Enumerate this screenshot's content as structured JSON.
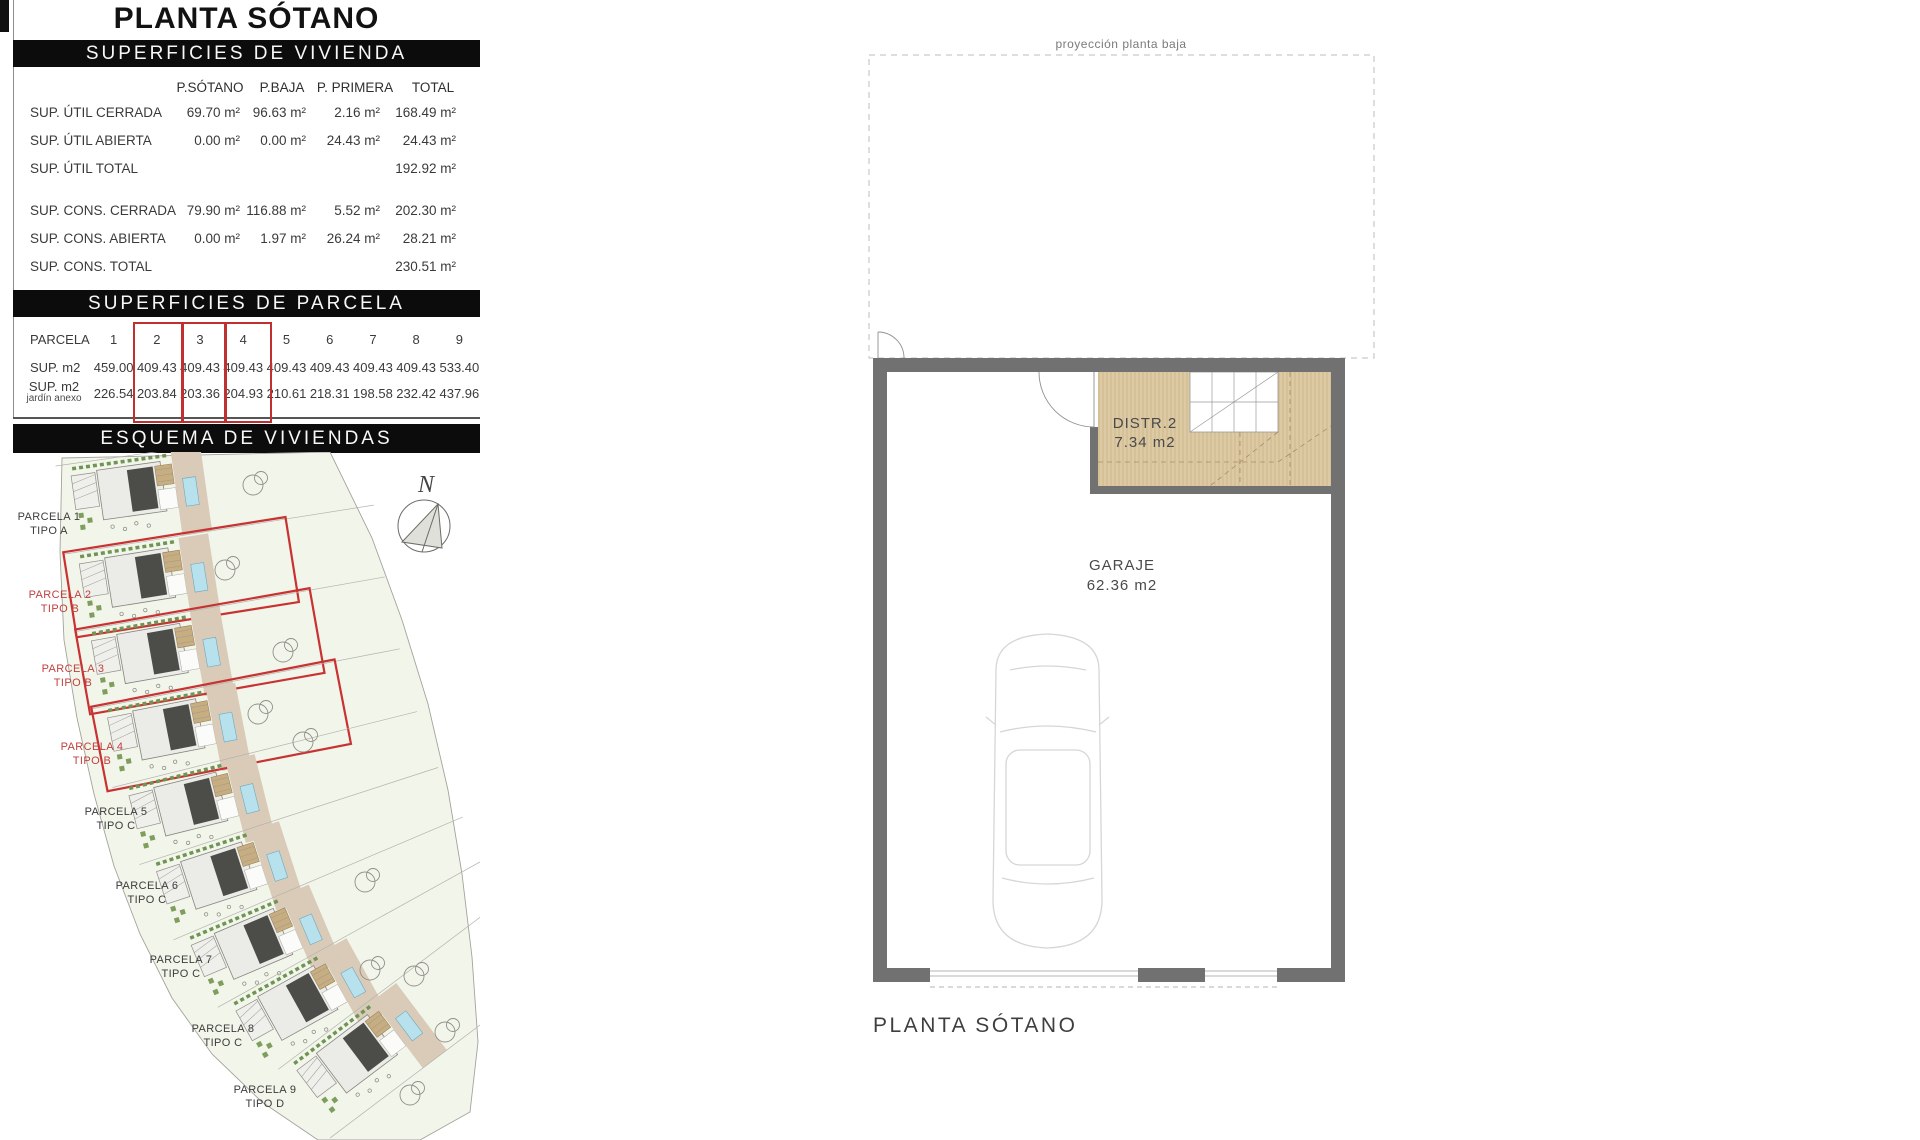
{
  "page": {
    "title": "PLANTA SÓTANO"
  },
  "viviendas": {
    "header": "SUPERFICIES DE VIVIENDA",
    "columns": [
      "P.SÓTANO",
      "P.BAJA",
      "P. PRIMERA",
      "TOTAL"
    ],
    "rows": [
      {
        "label": "SUP. ÚTIL CERRADA",
        "values": [
          "69.70 m²",
          "96.63 m²",
          "2.16 m²",
          "168.49 m²"
        ]
      },
      {
        "label": "SUP. ÚTIL ABIERTA",
        "values": [
          "0.00 m²",
          "0.00 m²",
          "24.43 m²",
          "24.43 m²"
        ]
      },
      {
        "label": "SUP. ÚTIL TOTAL",
        "values": [
          "",
          "",
          "",
          "192.92 m²"
        ]
      },
      {
        "label": "SUP. CONS.  CERRADA",
        "values": [
          "79.90 m²",
          "116.88 m²",
          "5.52 m²",
          "202.30 m²"
        ]
      },
      {
        "label": "SUP. CONS.  ABIERTA",
        "values": [
          "0.00 m²",
          "1.97 m²",
          "26.24 m²",
          "28.21 m²"
        ]
      },
      {
        "label": "SUP. CONS.  TOTAL",
        "values": [
          "",
          "",
          "",
          "230.51 m²"
        ]
      }
    ]
  },
  "parcelas": {
    "header": "SUPERFICIES DE PARCELA",
    "row1_label": "PARCELA",
    "row2_label": "SUP. m2",
    "row3_label_line1": "SUP. m2",
    "row3_label_line2": "jardín anexo",
    "numbers": [
      "1",
      "2",
      "3",
      "4",
      "5",
      "6",
      "7",
      "8",
      "9"
    ],
    "sup_m2": [
      "459.00",
      "409.43",
      "409.43",
      "409.43",
      "409.43",
      "409.43",
      "409.43",
      "409.43",
      "533.40"
    ],
    "jardin": [
      "226.54",
      "203.84",
      "203.36",
      "204.93",
      "210.61",
      "218.31",
      "198.58",
      "232.42",
      "437.96"
    ],
    "highlighted_columns": [
      "2",
      "3",
      "4"
    ]
  },
  "esquema": {
    "header": "ESQUEMA DE VIVIENDAS",
    "north_label": "N",
    "parcels": [
      {
        "name": "PARCELA 1",
        "tipo": "TIPO A"
      },
      {
        "name": "PARCELA 2",
        "tipo": "TIPO B"
      },
      {
        "name": "PARCELA 3",
        "tipo": "TIPO B"
      },
      {
        "name": "PARCELA 4",
        "tipo": "TIPO B"
      },
      {
        "name": "PARCELA 5",
        "tipo": "TIPO C"
      },
      {
        "name": "PARCELA 6",
        "tipo": "TIPO C"
      },
      {
        "name": "PARCELA 7",
        "tipo": "TIPO C"
      },
      {
        "name": "PARCELA 8",
        "tipo": "TIPO C"
      },
      {
        "name": "PARCELA 9",
        "tipo": "TIPO D"
      }
    ],
    "highlight_color": "#c83232"
  },
  "plan": {
    "projection_label": "proyección planta baja",
    "distr_label": "DISTR.2",
    "distr_area": "7.34 m2",
    "garage_label": "GARAJE",
    "garage_area": "62.36 m2",
    "caption": "PLANTA SÓTANO"
  },
  "colors": {
    "header_bar": "#0c0c0c",
    "highlight_red": "#c83232",
    "wall_gray": "#717171",
    "distr_tan": "#dccaa5",
    "pool_blue": "#b8e1ee",
    "site_green": "#f2f5ea"
  }
}
